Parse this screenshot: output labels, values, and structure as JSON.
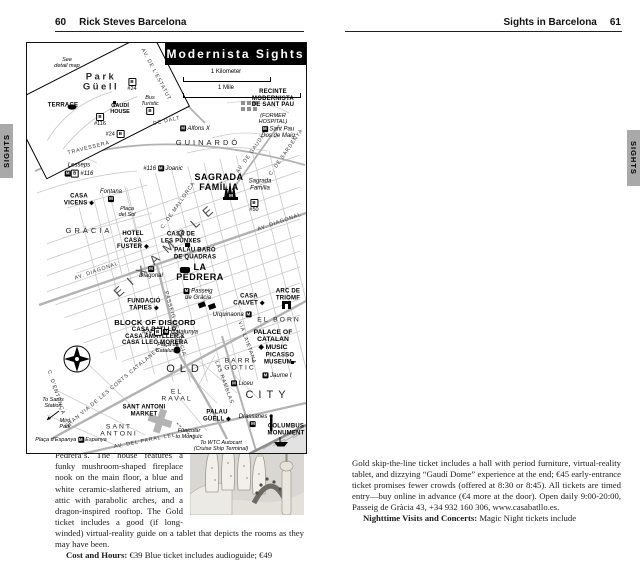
{
  "tabs": {
    "left": "SIGHTS",
    "right": "SIGHTS"
  },
  "icons": {
    "book": "◫",
    "audio": "Ω"
  },
  "left_page": {
    "page_number": "60",
    "header_title": "Rick Steves Barcelona",
    "paragraphs": [
      {
        "photo": "photo1",
        "segments": [
          {
            "t": "pete for your attention: Casa Batlló, Casa Amatller, and Casa Lleó Morera (all on Passeig de Gràcia—near the Metro stop of the same name—between Carrer del Consell de Cent and Carrer d’Aragó). All were built by well-known Modernista architects at the end of the 19th century. Because the mansions look as though they are trying to outdo each other in creative twists, locals nicknamed the noisy block the “Block of Discord.” Of the three houses, two are open to visitors—Casa Batlló and the less-crowded Casa Amatller."
          }
        ]
      },
      {
        "indent": true,
        "segments": [
          {
            "t": "By the way, if you’re tempted to snap photos from the middle of the street, be careful—Gaudí died after being struck by a streetcar."
          }
        ]
      },
      {
        "indent": true,
        "segments": [
          {
            "t": "From the Block of Discord, you’re four blocks from Gaudí’s "
          },
          {
            "t": "La Pedrera",
            "b": 1
          },
          {
            "t": " and a quick subway ride from his "
          },
          {
            "t": "Sagrada Família.",
            "b": 1
          }
        ]
      },
      {
        "indent": true,
        "segments": [
          {
            "t": "Even though Modernisme revolved around the Eixample, traces of this style can also be found elsewhere. Other Modernista highlights include Gaudí’s "
          },
          {
            "t": "Park Güell,",
            "b": 1
          },
          {
            "t": " where he put his colorful stamp on 30 acres of greenery, "
          },
          {
            "t": "Palau Güell,",
            "b": 1
          },
          {
            "t": " just off the Ramblas, and "
          },
          {
            "t": "Casa Vicens",
            "b": 1
          },
          {
            "t": " in the Gràcia district—the first house Gaudí designed. There’s also Lluís Domènech i Montaner’s "
          },
          {
            "t": "Palace of Catalan Music",
            "b": 1
          },
          {
            "t": " in El Born and Josep Puig i Cadafalch’s "
          },
          {
            "t": "CaixaForum",
            "b": 1
          },
          {
            "t": " at the base of Montjuïc."
          }
        ]
      },
      {
        "indent": true,
        "segments": [
          {
            "t": "For a tour of the Eixample, including a route that connects some of these sights, "
          },
          {
            "icon": "book"
          },
          {
            "t": " see the Eixample Walk chapter or "
          },
          {
            "icon": "audio"
          },
          {
            "t": " download my free Eixample Walk audio tour."
          }
        ]
      },
      {
        "heading": true,
        "segments": [
          {
            "t": "▲Casa Batlló"
          }
        ]
      },
      {
        "photo": "photo2",
        "segments": [
          {
            "t": "While the highlight of this Gaudí-designed residence is the roof, the interior is also interesting—and much more over-the-top than La Pedrera’s. The house features a funky mushroom-shaped fireplace nook on the main floor, a blue and white ceramic-slathered atrium, an attic with parabolic arches, and a dragon-inspired rooftop. The Gold ticket includes a good (if long-winded) virtual-reality guide on a tablet that depicts the rooms as they may have been."
          }
        ]
      },
      {
        "indent": true,
        "segments": [
          {
            "t": "Cost and Hours:",
            "b": 1
          },
          {
            "t": " €39 Blue ticket includes audioguide; €49"
          }
        ]
      }
    ]
  },
  "right_page": {
    "page_number": "61",
    "header_title": "Sights in Barcelona",
    "map": {
      "title": "Modernista Sights",
      "scale_km": "1 Kilometer",
      "scale_mile": "1 Mile",
      "labels": [
        {
          "n": "map-note-detail",
          "x": 40,
          "y": 20,
          "cls": "tinyit",
          "lines": [
            "See",
            "detail map"
          ]
        },
        {
          "n": "park-guell-label",
          "x": 74,
          "y": 40,
          "cls": "park",
          "lines": [
            "Park",
            "Güell"
          ]
        },
        {
          "n": "bus-24-park",
          "x": 105,
          "y": 42,
          "cls": "tiny",
          "lines": [
            "[B]",
            "#24"
          ]
        },
        {
          "n": "terrace-label",
          "x": 36,
          "y": 63,
          "cls": "poi",
          "lines": [
            "TERRACE"
          ]
        },
        {
          "n": "gaudi-house-label",
          "x": 93,
          "y": 66,
          "cls": "tinyb",
          "lines": [
            "GAUDÍ",
            "HOUSE"
          ]
        },
        {
          "n": "bus-116-park",
          "x": 73,
          "y": 77,
          "cls": "tiny",
          "lines": [
            "[B]",
            "#116"
          ]
        },
        {
          "n": "bus-turistic",
          "x": 123,
          "y": 62,
          "cls": "tinyit",
          "lines": [
            "Bus",
            "Turístic",
            "[B]"
          ]
        },
        {
          "n": "bus-24",
          "x": 88,
          "y": 91,
          "cls": "tiny",
          "lines": [
            "#24 [B]"
          ]
        },
        {
          "n": "street-travessera",
          "x": 62,
          "y": 106,
          "cls": "st",
          "rot": -14,
          "lines": [
            "TRAVESSERA"
          ]
        },
        {
          "n": "street-de-dalt",
          "x": 140,
          "y": 79,
          "cls": "st",
          "rot": -12,
          "lines": [
            "DE DALT"
          ]
        },
        {
          "n": "street-estatut",
          "x": 128,
          "y": 32,
          "cls": "st",
          "rot": 62,
          "lines": [
            "AV. DE L'ESTATUT"
          ]
        },
        {
          "n": "district-guinardo",
          "x": 181,
          "y": 100,
          "cls": "dist",
          "lines": [
            "GUINARDÓ"
          ]
        },
        {
          "n": "metro-alfons-x",
          "x": 168,
          "y": 86,
          "cls": "it",
          "lines": [
            "[M] Alfons X"
          ]
        },
        {
          "n": "metro-joanic",
          "x": 136,
          "y": 126,
          "cls": "it",
          "lines": [
            "#116 [M] Joanic"
          ]
        },
        {
          "n": "metro-lesseps",
          "x": 52,
          "y": 127,
          "cls": "it",
          "lines": [
            "Lesseps",
            "[M][B] #116"
          ]
        },
        {
          "n": "recinte-sant-pau",
          "x": 246,
          "y": 56,
          "cls": "poi",
          "lines": [
            "RECINTE",
            "MODERNISTA",
            "DE SANT PAU"
          ]
        },
        {
          "n": "recinte-sant-pau-sub",
          "x": 246,
          "y": 76,
          "cls": "tinyit",
          "lines": [
            "(FORMER",
            "HOSPITAL)"
          ]
        },
        {
          "n": "metro-sant-pau",
          "x": 251,
          "y": 90,
          "cls": "it",
          "lines": [
            "[M] Sant Pau",
            "Dos de Maig"
          ]
        },
        {
          "n": "sagrada-familia-label",
          "x": 192,
          "y": 140,
          "cls": "poi-lg",
          "lines": [
            "SAGRADA",
            "FAMÍLIA"
          ]
        },
        {
          "n": "metro-sagrada",
          "x": 204,
          "y": 153,
          "cls": "tiny",
          "lines": [
            "[M]"
          ]
        },
        {
          "n": "metro-sagrada-name",
          "x": 233,
          "y": 142,
          "cls": "it",
          "lines": [
            "Sagrada",
            "Família"
          ]
        },
        {
          "n": "bus-50",
          "x": 227,
          "y": 163,
          "cls": "tiny",
          "lines": [
            "[B]",
            "#50"
          ]
        },
        {
          "n": "street-av-gaudi",
          "x": 224,
          "y": 112,
          "cls": "st",
          "rot": -55,
          "lines": [
            "AV. DE GAUDÍ"
          ]
        },
        {
          "n": "street-sardenya",
          "x": 260,
          "y": 110,
          "cls": "st",
          "rot": -55,
          "lines": [
            "C. DE SARDENYA"
          ]
        },
        {
          "n": "street-mallorca",
          "x": 152,
          "y": 163,
          "cls": "st",
          "rot": -55,
          "lines": [
            "C. DE MALLORCA"
          ]
        },
        {
          "n": "district-gracia",
          "x": 62,
          "y": 188,
          "cls": "dist",
          "lines": [
            "GRÀCIA"
          ]
        },
        {
          "n": "casa-vicens-label",
          "x": 52,
          "y": 157,
          "cls": "poi",
          "lines": [
            "CASA",
            "VICENS ◆"
          ]
        },
        {
          "n": "metro-fontana",
          "x": 84,
          "y": 153,
          "cls": "it",
          "lines": [
            "Fontana",
            "[M]"
          ]
        },
        {
          "n": "placa-del-sol",
          "x": 100,
          "y": 169,
          "cls": "tinyit",
          "lines": [
            "Plaça",
            "del Sol"
          ]
        },
        {
          "n": "hotel-casa-fuster",
          "x": 106,
          "y": 198,
          "cls": "poi",
          "lines": [
            "HOTEL",
            "CASA",
            "FUSTER ◆"
          ]
        },
        {
          "n": "casa-punxes",
          "x": 154,
          "y": 195,
          "cls": "poi",
          "lines": [
            "CASA DE",
            "LES PUNXES"
          ]
        },
        {
          "n": "palau-quadras",
          "x": 168,
          "y": 211,
          "cls": "poi",
          "lines": [
            "PALAU BARÓ",
            "DE QUADRAS"
          ]
        },
        {
          "n": "la-pedrera-label",
          "x": 173,
          "y": 230,
          "cls": "poi-lg",
          "lines": [
            "LA",
            "PEDRERA"
          ]
        },
        {
          "n": "metro-diagonal",
          "x": 124,
          "y": 230,
          "cls": "it",
          "lines": [
            "[M]",
            "Diagonal"
          ]
        },
        {
          "n": "street-diagonal-w",
          "x": 70,
          "y": 229,
          "cls": "st",
          "rot": -19,
          "lines": [
            "AV. DIAGONAL"
          ]
        },
        {
          "n": "street-diagonal-e",
          "x": 253,
          "y": 180,
          "cls": "st",
          "rot": -19,
          "lines": [
            "AV. DIAGONAL"
          ]
        },
        {
          "n": "district-eixample",
          "x": 140,
          "y": 206,
          "cls": "big",
          "rot": -42,
          "lines": [
            "EIXAMPLE"
          ]
        },
        {
          "n": "fundacio-tapies",
          "x": 117,
          "y": 262,
          "cls": "poi",
          "lines": [
            "FUNDACIÓ",
            "TÀPIES ◆"
          ]
        },
        {
          "n": "metro-pg-gracia",
          "x": 171,
          "y": 252,
          "cls": "it",
          "lines": [
            "[M] Passeig",
            "de Gràcia"
          ]
        },
        {
          "n": "street-pg-gracia",
          "x": 147,
          "y": 281,
          "cls": "st",
          "rot": 74,
          "lines": [
            "PASSEIG DE GRÀCIA"
          ]
        },
        {
          "n": "block-of-discord",
          "x": 128,
          "y": 280,
          "cls": "poi-md",
          "lines": [
            "BLOCK OF DISCORD"
          ]
        },
        {
          "n": "block-of-discord-casas",
          "x": 128,
          "y": 294,
          "cls": "poi",
          "lines": [
            "CASA BATLLÓ,",
            "CASA AMATLLER &",
            "CASA LLEÓ MORERA"
          ]
        },
        {
          "n": "casa-calvet",
          "x": 222,
          "y": 257,
          "cls": "poi",
          "lines": [
            "CASA",
            "CALVET ◆"
          ]
        },
        {
          "n": "arc-de-triomf",
          "x": 261,
          "y": 252,
          "cls": "poi",
          "lines": [
            "ARC DE",
            "TRIOMF"
          ]
        },
        {
          "n": "district-el-born",
          "x": 252,
          "y": 277,
          "cls": "dist2",
          "lines": [
            "EL BORN"
          ]
        },
        {
          "n": "metro-urquinaona",
          "x": 205,
          "y": 272,
          "cls": "it",
          "lines": [
            "Urquinaona [M]"
          ]
        },
        {
          "n": "palace-catalan-music",
          "x": 246,
          "y": 297,
          "cls": "poi-md2",
          "lines": [
            "PALACE OF",
            "CATALAN",
            "◆ MUSIC"
          ]
        },
        {
          "n": "picasso-museum",
          "x": 253,
          "y": 316,
          "cls": "poi",
          "lines": [
            "PICASSO",
            "MUSEUM ▪"
          ]
        },
        {
          "n": "street-laietana",
          "x": 219,
          "y": 300,
          "cls": "st",
          "rot": 70,
          "lines": [
            "VIA LAIETANA"
          ]
        },
        {
          "n": "metro-catalunya",
          "x": 143,
          "y": 289,
          "cls": "it",
          "lines": [
            "#24 [B] [M] Catalunya"
          ]
        },
        {
          "n": "placa-catalunya",
          "x": 141,
          "y": 305,
          "cls": "tinyit",
          "lines": [
            "Plaça de",
            "Catalunya"
          ]
        },
        {
          "n": "district-old",
          "x": 158,
          "y": 326,
          "cls": "dist-lg",
          "lines": [
            "OLD"
          ]
        },
        {
          "n": "district-city",
          "x": 241,
          "y": 352,
          "cls": "dist-lg",
          "lines": [
            "CITY"
          ]
        },
        {
          "n": "district-barri-gotic",
          "x": 213,
          "y": 322,
          "cls": "dist2",
          "lines": [
            "BARRI",
            "GÒTIC"
          ]
        },
        {
          "n": "metro-jaume",
          "x": 250,
          "y": 333,
          "cls": "it",
          "lines": [
            "[M] Jaume I"
          ]
        },
        {
          "n": "metro-liceu",
          "x": 215,
          "y": 341,
          "cls": "it",
          "lines": [
            "[M] Liceu"
          ]
        },
        {
          "n": "district-el-raval",
          "x": 150,
          "y": 353,
          "cls": "dist2",
          "lines": [
            "EL",
            "RAVAL"
          ]
        },
        {
          "n": "street-ramblas",
          "x": 196,
          "y": 340,
          "cls": "st",
          "rot": 70,
          "lines": [
            "LAS RAMBLAS"
          ]
        },
        {
          "n": "palau-guell-label",
          "x": 190,
          "y": 373,
          "cls": "poi",
          "lines": [
            "PALAU",
            "GÜELL ◆"
          ]
        },
        {
          "n": "metro-drassanes",
          "x": 226,
          "y": 378,
          "cls": "it",
          "lines": [
            "Drassanes",
            "[M]"
          ]
        },
        {
          "n": "columbus-monument",
          "x": 259,
          "y": 387,
          "cls": "poi",
          "lines": [
            "COLUMBUS",
            "MONUMENT"
          ]
        },
        {
          "n": "funicular-note",
          "x": 162,
          "y": 391,
          "cls": "tinyit",
          "lines": [
            "Funicular",
            "to Montjuïc"
          ]
        },
        {
          "n": "wtc-note",
          "x": 194,
          "y": 403,
          "cls": "tinyit",
          "lines": [
            "To WTC Autocart",
            "(Cruise Ship Terminal)"
          ]
        },
        {
          "n": "street-parallel",
          "x": 118,
          "y": 399,
          "cls": "st",
          "rot": -11,
          "lines": [
            "AV.  DEL  PARAL·LEL"
          ]
        },
        {
          "n": "street-gran-via",
          "x": 86,
          "y": 346,
          "cls": "st",
          "rot": -40,
          "lines": [
            "GRAN VIA DE LES CORTS CATALANES"
          ]
        },
        {
          "n": "district-sant-antoni",
          "x": 92,
          "y": 388,
          "cls": "dist2",
          "lines": [
            "SANT",
            "ANTONI"
          ]
        },
        {
          "n": "sant-antoni-market",
          "x": 117,
          "y": 368,
          "cls": "poi",
          "lines": [
            "SANT ANTONI",
            "MARKET"
          ]
        },
        {
          "n": "sants-note",
          "x": 26,
          "y": 360,
          "cls": "tinyit",
          "lines": [
            "To Sants",
            "Station"
          ]
        },
        {
          "n": "miro-park",
          "x": 38,
          "y": 381,
          "cls": "tinyit",
          "lines": [
            "Miró",
            "Park"
          ]
        },
        {
          "n": "placa-espanya",
          "x": 44,
          "y": 397,
          "cls": "tinyit",
          "lines": [
            "Plaça d’Espanya [M] Espanya"
          ]
        },
        {
          "n": "street-entenca",
          "x": 28,
          "y": 350,
          "cls": "st",
          "rot": 72,
          "lines": [
            "C. D'ENTENÇA"
          ]
        }
      ]
    },
    "paragraphs": [
      {
        "segments": [
          {
            "t": "Gold skip-the-line ticket includes a hall with period furniture, virtual-reality tablet, and dizzying “Gaudí Dome” experience at the end; €45 early-entrance ticket promises fewer crowds (offered at 8:30 or 8:45). All tickets are timed entry—buy online in advance (€4 more at the door). Open daily 9:00-20:00, Passeig de Gràcia 43, +34 932 160 306, www.casabatllo.es."
          }
        ]
      },
      {
        "indent": true,
        "segments": [
          {
            "t": "Nighttime Visits and Concerts:",
            "b": 1
          },
          {
            "t": " Magic Night tickets include"
          }
        ]
      }
    ]
  }
}
